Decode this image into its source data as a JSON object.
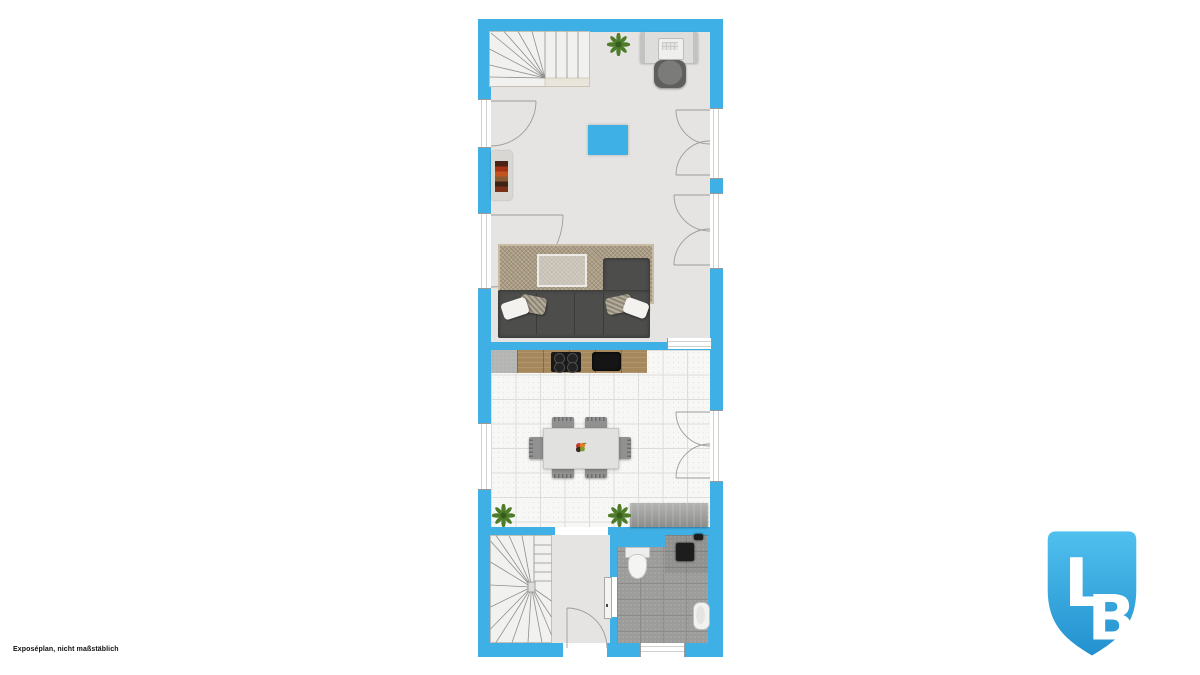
{
  "footer": {
    "disclaimer": "Exposéplan, nicht maßstäblich"
  },
  "logo": {
    "letters": [
      "L",
      "B"
    ]
  },
  "colors": {
    "wall": "#3FB0E5",
    "floor": "#E5E4E2",
    "tile-bg": "#F7F7F5",
    "tile-line": "#DCDCDA",
    "tile-speck": "#E4E4E2",
    "rug": "#AC9E86",
    "sofa": "#4D4D4B",
    "wood": "#A5885C",
    "bath-tile": "#9C9C9A",
    "bath-grout": "#8B8B89",
    "stair-fill": "#F1F1EF",
    "logo-top": "#4FC0EE",
    "logo-bottom": "#2391CF"
  }
}
